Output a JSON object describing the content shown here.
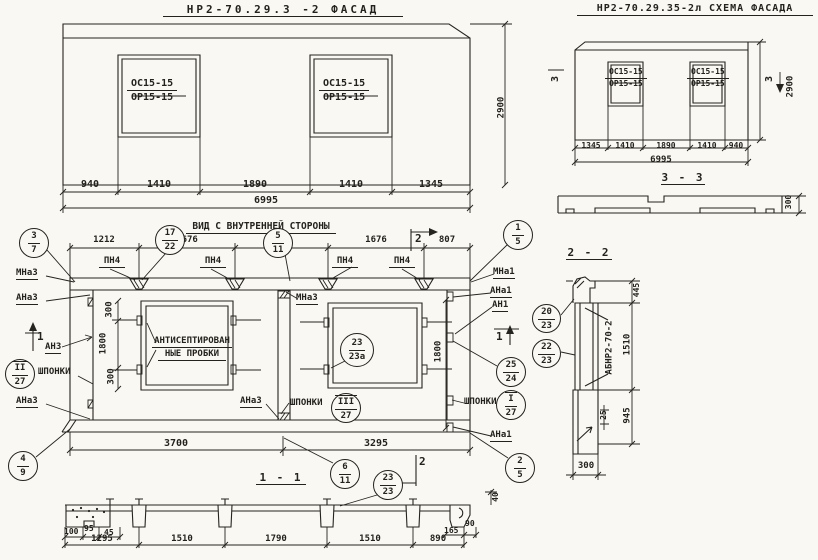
{
  "facade": {
    "title": "НР2-70.29.3 -2  ФАСАД",
    "win_top": "ОС15-15",
    "win_bot": "ОР15-15",
    "dims": [
      "940",
      "1410",
      "1890",
      "1410",
      "1345"
    ],
    "total": "6995",
    "height": "2900"
  },
  "schema": {
    "title": "НР2-70.29.35-2л СХЕМА ФАСАДА",
    "win_top": "ОС15-15",
    "win_bot": "ОР15-15",
    "dims": [
      "1345",
      "1410",
      "1890",
      "1410",
      "940"
    ],
    "total": "6995",
    "height": "2900",
    "cut": "3"
  },
  "s33": {
    "title": "3 - 3",
    "depth": "300"
  },
  "view": {
    "title": "ВИД С ВНУТРЕННЕЙ СТОРОНЫ",
    "top_dims": [
      "1212",
      "1676",
      "1624",
      "1676",
      "807"
    ],
    "bot_dims": [
      "3700",
      "3295"
    ],
    "pn4": "ПН4",
    "labels": {
      "mna3": "МНа3",
      "ana3": "АНа3",
      "an3": "АН3",
      "mna1": "МНа1",
      "ana1": "АНа1",
      "an1": "АН1",
      "shponki": "ШПОНКИ",
      "plugs1": "АНТИСЕПТИРОВАН",
      "plugs2": "НЫЕ ПРОБКИ"
    },
    "d300": "300",
    "d1800": "1800",
    "cut1": "1",
    "cut2": "2"
  },
  "s11": {
    "title": "1 - 1",
    "dims": [
      "1295",
      "1510",
      "1790",
      "1510",
      "890"
    ],
    "d100": "100",
    "d95": "95",
    "d45": "45",
    "d165": "165",
    "d90": "90",
    "d40": "40"
  },
  "s22": {
    "title": "2 - 2",
    "mark": "АБНР2-70-2",
    "d445": "445",
    "d1510": "1510",
    "d945": "945",
    "d25": "25",
    "d300": "300"
  },
  "balloons": {
    "c37": {
      "t": "3",
      "b": "7"
    },
    "c1722": {
      "t": "17",
      "b": "22"
    },
    "c511": {
      "t": "5",
      "b": "11"
    },
    "c15": {
      "t": "1",
      "b": "5"
    },
    "c227": {
      "t": "II",
      "b": "27"
    },
    "c49": {
      "t": "4",
      "b": "9"
    },
    "c611": {
      "t": "6",
      "b": "11"
    },
    "c327": {
      "t": "III",
      "b": "27"
    },
    "c2323a": {
      "t": "23",
      "b": "23а"
    },
    "c2323": {
      "t": "23",
      "b": "23"
    },
    "c2524": {
      "t": "25",
      "b": "24"
    },
    "c127": {
      "t": "I",
      "b": "27"
    },
    "c25": {
      "t": "2",
      "b": "5"
    },
    "c2023": {
      "t": "20",
      "b": "23"
    },
    "c2223": {
      "t": "22",
      "b": "23"
    }
  }
}
